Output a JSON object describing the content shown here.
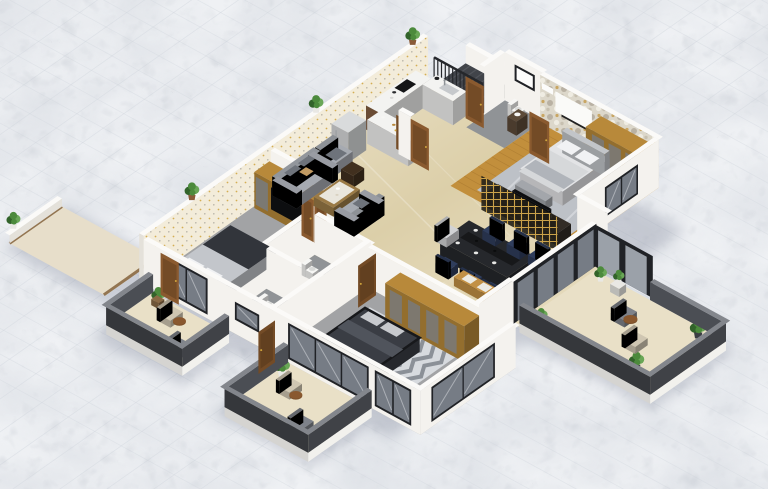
{
  "scene": {
    "description": "Isometric 3D floor plan render of a furnished apartment standing on white marble tiles",
    "style": "3d-isometric-floorplan",
    "rooms": [
      {
        "id": "kitchen",
        "label": "Kitchen",
        "furniture": [
          "u-shaped-counter",
          "cooktop",
          "sink",
          "refrigerator",
          "entry-door"
        ]
      },
      {
        "id": "entry-stairs",
        "label": "Entry stairs",
        "furniture": [
          "staircase",
          "black-railing"
        ]
      },
      {
        "id": "living-room",
        "label": "Living room",
        "furniture": [
          "three-seat-sofa",
          "loveseat",
          "armchair",
          "coffee-table",
          "side-cube-table"
        ]
      },
      {
        "id": "dining-room",
        "label": "Dining room",
        "furniture": [
          "dark-dining-table",
          "navy-chairs",
          "end-chairs",
          "gold-partition-screen",
          "window-benches"
        ]
      },
      {
        "id": "master-bedroom",
        "label": "Master bedroom",
        "furniture": [
          "double-bed",
          "foot-bench",
          "tv-console",
          "gold-wardrobe",
          "marble-grey-rug",
          "wall-panel",
          "air-conditioner"
        ]
      },
      {
        "id": "bathroom-1",
        "label": "Bathroom 1",
        "furniture": [
          "toilet",
          "vanity",
          "mirror"
        ]
      },
      {
        "id": "bedroom-2",
        "label": "Bedroom 2",
        "furniture": [
          "bed-dark-duvet",
          "wardrobe-tv-unit",
          "open-double-doors"
        ]
      },
      {
        "id": "bathrooms-23",
        "label": "Bathrooms",
        "furniture": [
          "toilet",
          "toilet",
          "vanity",
          "shower"
        ]
      },
      {
        "id": "bedroom-3",
        "label": "Bedroom 3",
        "furniture": [
          "dark-bed",
          "chevron-rug",
          "gold-wardrobe",
          "open-door"
        ]
      },
      {
        "id": "balcony-1",
        "label": "Balcony 1",
        "furniture": [
          "potted-plant",
          "beige-armchair",
          "round-table",
          "grey-chair"
        ]
      },
      {
        "id": "balcony-2",
        "label": "Balcony 2",
        "furniture": [
          "potted-plant",
          "beige-armchair",
          "round-table",
          "grey-chair",
          "open-door"
        ]
      },
      {
        "id": "balcony-large",
        "label": "Large balcony",
        "furniture": [
          "plant-stands",
          "potted-plants",
          "dark-lounge-chair",
          "beige-chair",
          "round-table"
        ]
      },
      {
        "id": "side-patio",
        "label": "Side patio",
        "furniture": [
          "potted-plant"
        ]
      }
    ],
    "exterior": {
      "ground": "white-marble-tile",
      "wall_top_plants": 3
    },
    "palette": {
      "marbleBase": "#eff1f4",
      "marbleTint": "#dde2e9",
      "seam": "#c7cdd6",
      "beige1": "#f0e8d3",
      "beige2": "#dccfa9",
      "beigeBalcony": "#e9e0c7",
      "woodFloor": "#c28f3c",
      "woodLine": "#a4742c",
      "rug": "#bdc1c7",
      "rugStreak": "#d8dbdf",
      "greyFloor": "#a2a3a5",
      "bathFloor": "#909396",
      "shower": "#7b7e83",
      "chevA": "#d7dade",
      "chevB": "#7e838b",
      "wallWhite": "#f4f2ee",
      "wallShade": "#e4e1da",
      "wallCap": "#fbfaf8",
      "wpCream": "#f3ecda",
      "dotGold": "#cfa43c",
      "dotGrey": "#a8a49a",
      "floralBase": "#dcd7ca",
      "floralGrey": "#b3ab9c",
      "floralGold": "#c49a4b",
      "floralLight": "#efece2",
      "doorWood": "#8a5a2f",
      "doorDark": "#734b26",
      "doorLine": "#5d3a1e",
      "frameDark": "#202226",
      "glass": "#767c85",
      "glassLight": "#9ba1a9",
      "streak": "#eceef1",
      "sofa": "#a6aab1",
      "sofaDark": "#8b9097",
      "cushion": "#6e737b",
      "tanPillow": "#c19a63",
      "ctWood": "#9a7a46",
      "glassTop": "#e9e6dd",
      "cube": "#41301f",
      "counter": "#f3f3f1",
      "cabinet": "#6a4c34",
      "cooktop": "#141517",
      "steel": "#c6c9cc",
      "fridge": "#d9dbdc",
      "dTable": "#26282c",
      "navy": "#2f3d5c",
      "chairLight": "#d2d3d5",
      "bench": "#c29045",
      "cushW": "#eceae2",
      "gold": "#b8893a",
      "lattice": "#caa24a",
      "latticeBg": "#242017",
      "bedW": "#e3e4e6",
      "bedHead": "#c2c5c9",
      "duvet": "#d6d8da",
      "throw": "#b0b4ba",
      "benchGrey": "#a3a6ab",
      "pillowW": "#f1f2f4",
      "bed2Dark": "#32353b",
      "bed2Light": "#c3c6cb",
      "bed3Top": "#3a3d44",
      "bed3Rim": "#17181b",
      "bed3Fold": "#50545c",
      "pillowG": "#c7c9cd",
      "parapet": "#4b4e54",
      "parapetTop": "#83868c",
      "slab": "#f2f1ed",
      "stair": "#41444a",
      "tread": "#54575d",
      "rail": "#25272b",
      "green": "#4c8a3c",
      "greenD": "#32632a",
      "greenL": "#6aa757",
      "potW": "#e9e8e4",
      "potD": "#3b3e43",
      "potT": "#8a5b38",
      "ceramic": "#f6f6f4",
      "ceramicShade": "#d9dad8",
      "tv": "#0d0e10",
      "board": "#fafaf8",
      "rTable": "#7a4f2a",
      "chairBeige": "#cfc6b2",
      "chairGrey": "#7e828a",
      "shadow": "#46506b"
    }
  }
}
